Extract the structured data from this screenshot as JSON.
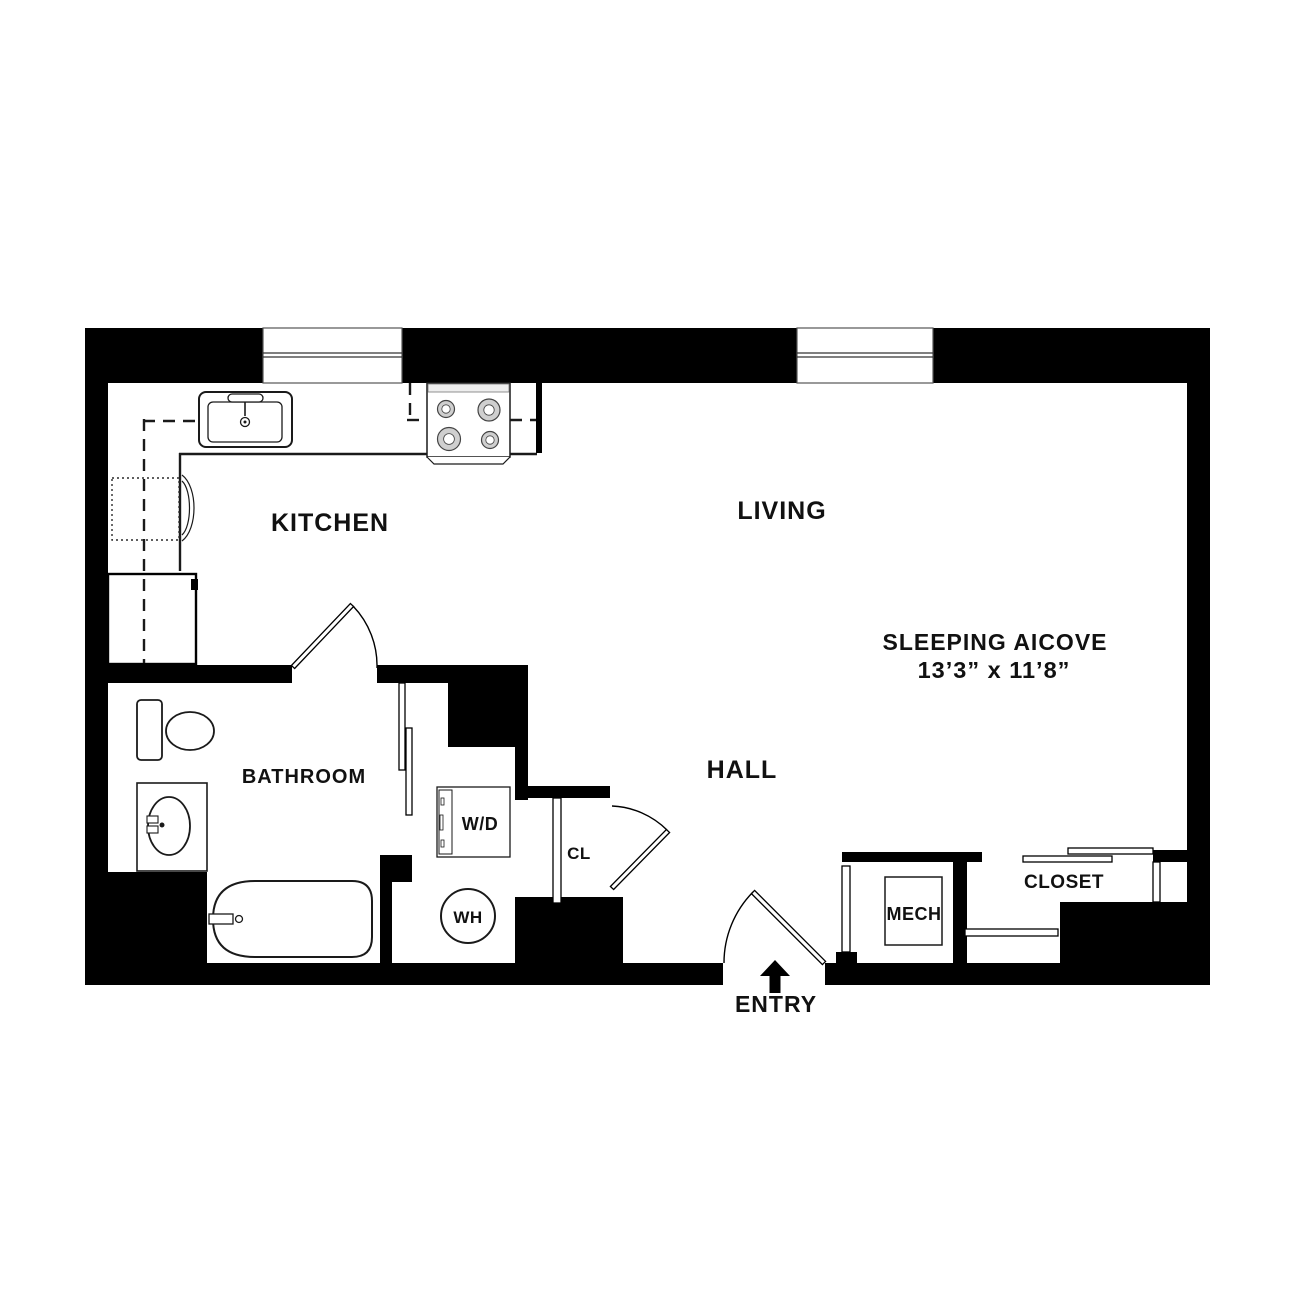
{
  "labels": {
    "kitchen": "KITCHEN",
    "living": "LIVING",
    "sleeping_alcove": "SLEEPING AICOVE",
    "sleeping_alcove_dimensions": "13’3” x 11’8”",
    "bathroom": "BATHROOM",
    "hall": "HALL",
    "washer_dryer": "W/D",
    "hall_closet": "CL",
    "water_heater": "WH",
    "mechanical": "MECH",
    "closet": "CLOSET",
    "entry": "ENTRY"
  },
  "colors": {
    "walls": "#000000",
    "background": "#ffffff",
    "label_text": "#111111",
    "fixture_outline": "#1a1a1a"
  },
  "fixture_icons": [
    "window-icon",
    "door-swing-icon",
    "pocket-door-icon",
    "sliding-door-icon",
    "kitchen-sink-icon",
    "range-icon",
    "refrigerator-icon",
    "corner-cabinet-icon",
    "toilet-icon",
    "vanity-sink-icon",
    "bathtub-icon",
    "washer-dryer-icon",
    "water-heater-icon",
    "mech-unit-icon",
    "entry-arrow-icon"
  ]
}
